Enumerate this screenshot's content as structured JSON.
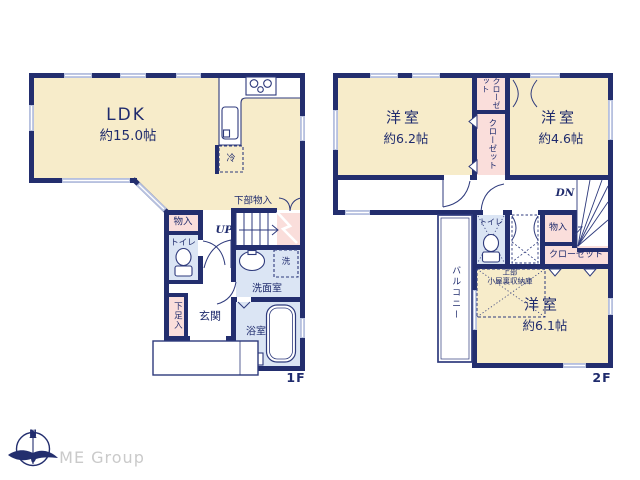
{
  "floor1": {
    "floor_label": "1F",
    "ldk": "LDK",
    "ldk_size": "約15.0帖",
    "fridge": "冷",
    "under_stair_storage": "下部物入",
    "storage": "物入",
    "stairs_up": "UP",
    "toilet": "トイレ",
    "washing_machine": "洗",
    "washroom": "洗面室",
    "shoe_storage": "下足入",
    "entrance": "玄関",
    "bathroom": "浴室"
  },
  "floor2": {
    "floor_label": "2F",
    "bedroom_left": "洋室",
    "bedroom_left_size": "約6.2帖",
    "closet_upper": "クローゼット",
    "closet_middle": "クローゼット",
    "bedroom_right": "洋室",
    "bedroom_right_size": "約4.6帖",
    "stairs_down": "DN",
    "toilet": "トイレ",
    "storage": "物入",
    "closet": "クローゼット",
    "attic_line1": "上部",
    "attic_line2": "小屋裏収納庫",
    "balcony": "バルコニー",
    "bedroom_bottom": "洋室",
    "bedroom_bottom_size": "約6.1帖"
  },
  "footer": {
    "compass_north": "N",
    "brand": "ME Group"
  },
  "colors": {
    "wall": "#232e6e",
    "room_cream": "#f7ecca",
    "closet_pink": "#fadedb",
    "wet_blue": "#dbe5f4",
    "window": "#b7c1df",
    "text": "#1f2b6d",
    "brand_gray": "#cacaca"
  }
}
